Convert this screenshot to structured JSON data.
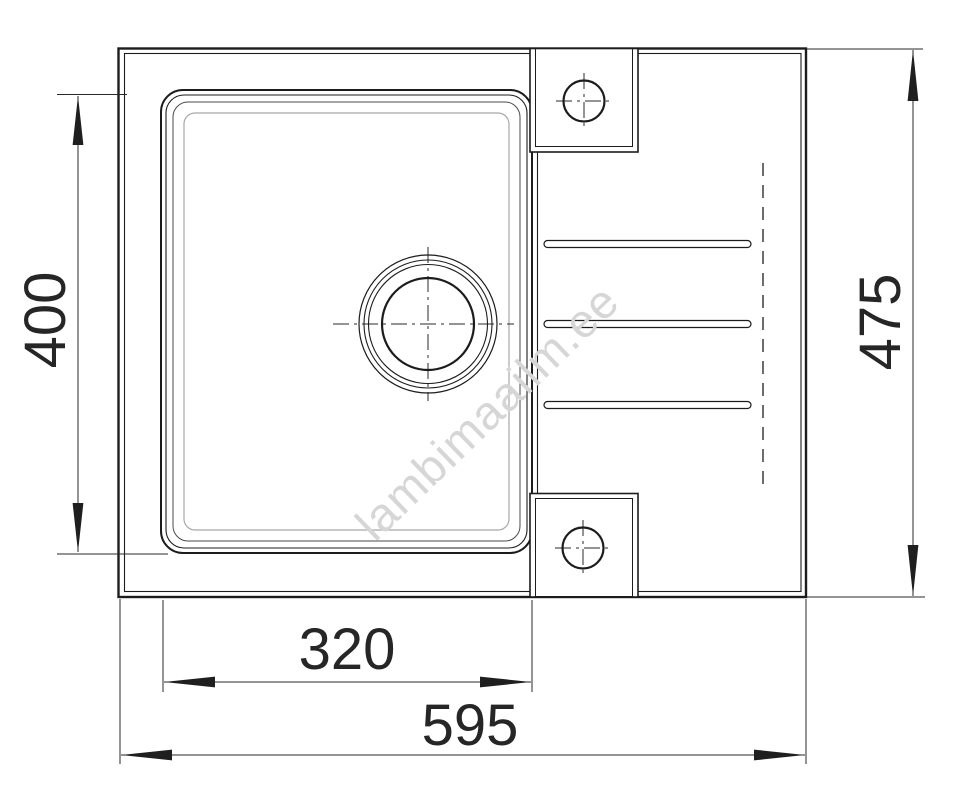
{
  "drawing": {
    "subject": "kitchen-sink-top-view-technical-drawing",
    "watermark": "lambimaailm.ee",
    "dimensions": {
      "bowl_length_left": "400",
      "overall_depth_right": "475",
      "bowl_width_bottom": "320",
      "overall_width_bottom": "595"
    },
    "colors": {
      "line": "#1c1c1c",
      "secondary_rim_line": "#a8a8a8",
      "dimension": "#262626",
      "watermark": "#d6d6d6",
      "background": "#ffffff"
    }
  }
}
